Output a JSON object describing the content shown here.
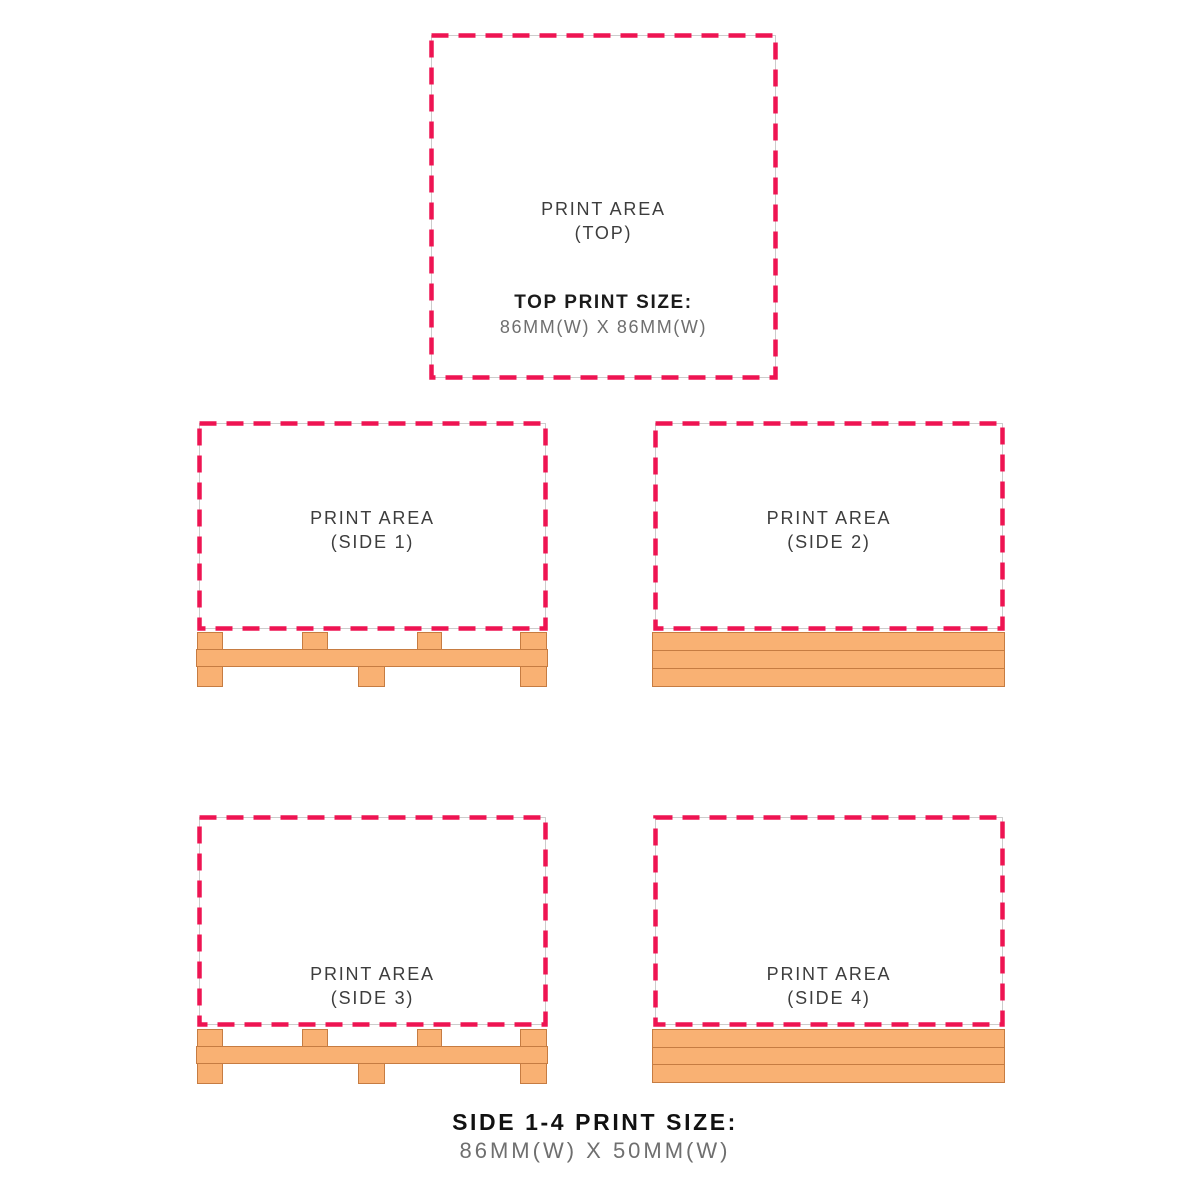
{
  "colors": {
    "dash_border": "#ee1452",
    "underlay_line": "#cccccc",
    "wood_fill": "#f9b173",
    "wood_outline": "#c67c42",
    "area_label_text": "#3d3d3d",
    "heading_text": "#1b1b1b",
    "muted_text": "#6f6f6f",
    "background": "#ffffff"
  },
  "panels": {
    "top": {
      "label_line1": "PRINT AREA",
      "label_line2": "(TOP)",
      "size_title": "TOP PRINT SIZE:",
      "size_value": "86MM(W) X 86MM(W)"
    },
    "side1": {
      "label_line1": "PRINT AREA",
      "label_line2": "(SIDE 1)"
    },
    "side2": {
      "label_line1": "PRINT AREA",
      "label_line2": "(SIDE 2)"
    },
    "side3": {
      "label_line1": "PRINT AREA",
      "label_line2": "(SIDE 3)"
    },
    "side4": {
      "label_line1": "PRINT AREA",
      "label_line2": "(SIDE 4)"
    }
  },
  "caption": {
    "title": "SIDE 1-4 PRINT SIZE:",
    "value": "86MM(W) X 50MM(W)"
  }
}
